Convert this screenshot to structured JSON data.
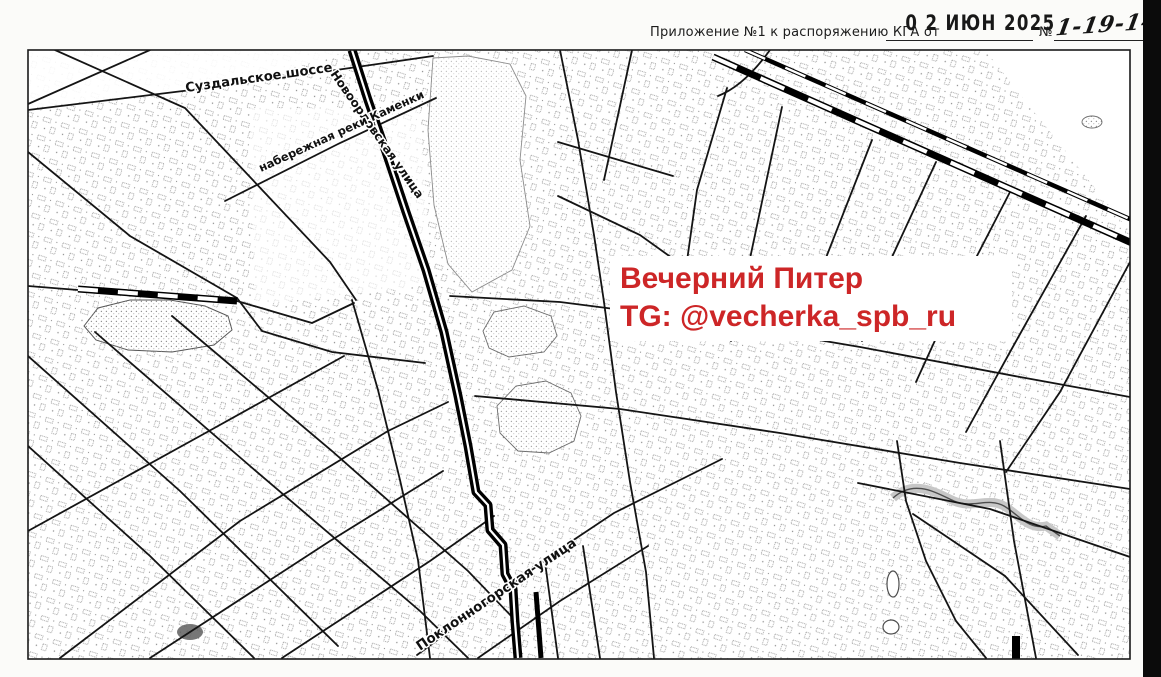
{
  "document": {
    "header": {
      "label": "Приложение №1 к распоряжению КГА от",
      "stamp_date": "0 2 ИЮН 2025",
      "number_sign": "№",
      "document_number": "1-19-146"
    }
  },
  "watermark": {
    "line1": "Вечерний Питер",
    "line2": "TG: @vecherka_spb_ru",
    "text_color": "#cd2627",
    "background": "#ffffff"
  },
  "map": {
    "type": "scanned-street-map",
    "ink_color": "#111111",
    "labels": {
      "suzdalskoe": "Суздальское шоссе",
      "novoorlovskaya": "Новоорловская улица",
      "kamenki": "набережная реки Каменки",
      "poklonnogorskaya": "Поклонногорская улица"
    }
  }
}
